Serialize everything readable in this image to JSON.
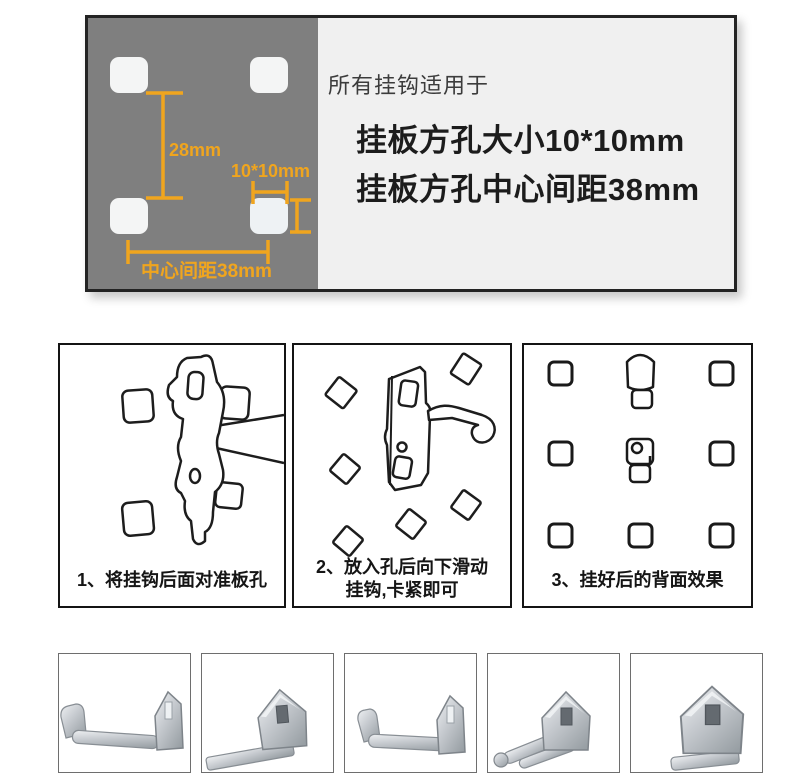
{
  "spec_card": {
    "heading": "所有挂钩适用于",
    "spec_lines": [
      "挂板方孔大小10*10mm",
      "挂板方孔中心间距38mm"
    ],
    "dimensions": {
      "row_spacing": "28mm",
      "hole_size": "10*10mm",
      "center_distance": "中心间距38mm"
    }
  },
  "steps": [
    {
      "caption_lines": [
        "1、将挂钩后面对准板孔"
      ]
    },
    {
      "caption_lines": [
        "2、放入孔后向下滑动",
        "挂钩,卡紧即可"
      ]
    },
    {
      "caption_lines": [
        "3、挂好后的背面效果"
      ]
    }
  ],
  "colors": {
    "accent_orange": "#F0A51E",
    "panel_gray": "#7F7F7F",
    "panel_light": "#F0F0F0",
    "ink": "#1C1C1C",
    "metal_light": "#EFF1F3",
    "metal_dark": "#989FA4"
  }
}
